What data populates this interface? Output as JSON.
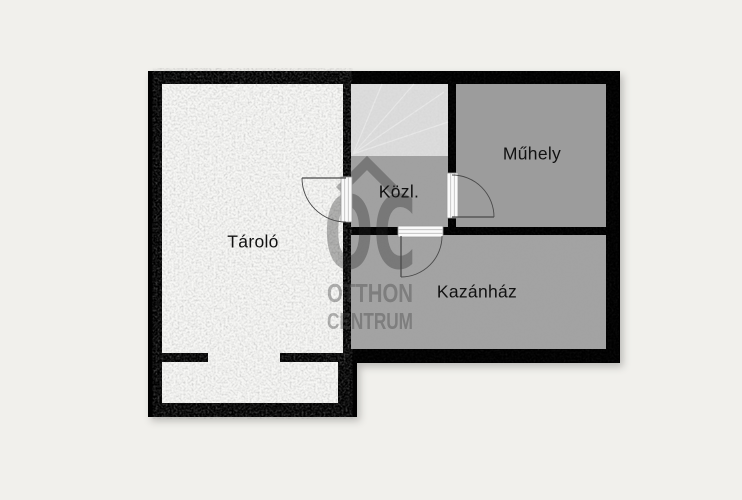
{
  "plan": {
    "rooms": [
      {
        "name": "Tároló"
      },
      {
        "name": "Közl."
      },
      {
        "name": "Műhely"
      },
      {
        "name": "Kazánház"
      }
    ],
    "watermark": {
      "logo": "OC",
      "line1": "OTTHON",
      "line2": "CENTRUM"
    },
    "colors": {
      "background": "#f1f0ec",
      "wall": "#060606",
      "floor_tarolo": "#f7f7f5",
      "floor_stairs": "#dcdcdc",
      "floor_kozl": "#a1a1a1",
      "floor_muhely": "#9c9c9c",
      "floor_kazanhaz": "#a3a3a3",
      "door_frame": "#fafafa",
      "door_stroke": "#4a4a4a",
      "label_text": "#111111",
      "watermark_logo": "rgba(35,35,35,0.33)",
      "watermark_text": "rgba(70,70,70,0.40)"
    }
  }
}
